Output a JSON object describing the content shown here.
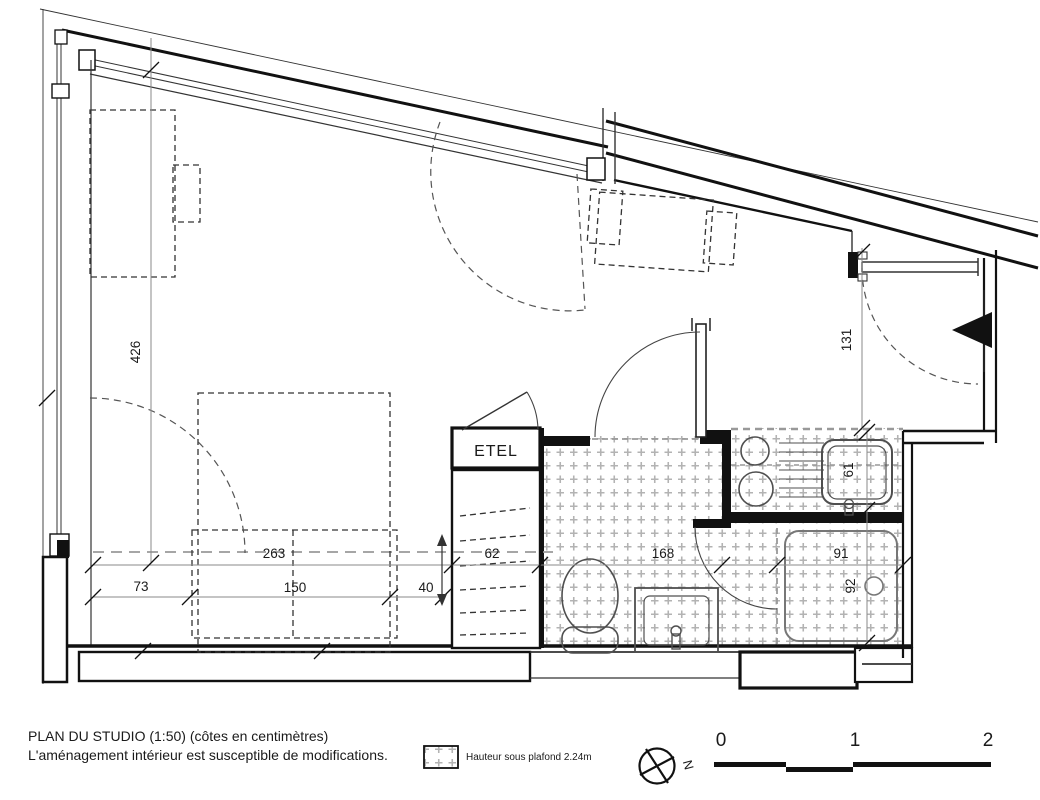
{
  "title_block": {
    "line1": "PLAN DU STUDIO (1:50) (côtes en centimètres)",
    "line2": "L'aménagement intérieur est susceptible de modifications."
  },
  "legend": {
    "ceiling_height_label": "Hauteur sous plafond 2.24m"
  },
  "compass": {
    "north": "N"
  },
  "scale_bar": {
    "tick0": "0",
    "tick1": "1",
    "tick2": "2"
  },
  "rooms": {
    "closet_label": "ETEL"
  },
  "dimensions": {
    "room_height": "426",
    "entry_depth": "131",
    "bed_zone_width": "263",
    "bed_offset_left": "73",
    "bed_width": "150",
    "bed_offset_right": "40",
    "closet_width": "62",
    "bathroom_width": "168",
    "sink_depth": "61",
    "shower_width": "91",
    "shower_depth": "92"
  },
  "colors": {
    "wall": "#111111",
    "line": "#333333",
    "dimension": "#8a8a8a",
    "hatch": "#b3b3b3",
    "fixture": "#4f4f4f",
    "background": "#ffffff"
  }
}
